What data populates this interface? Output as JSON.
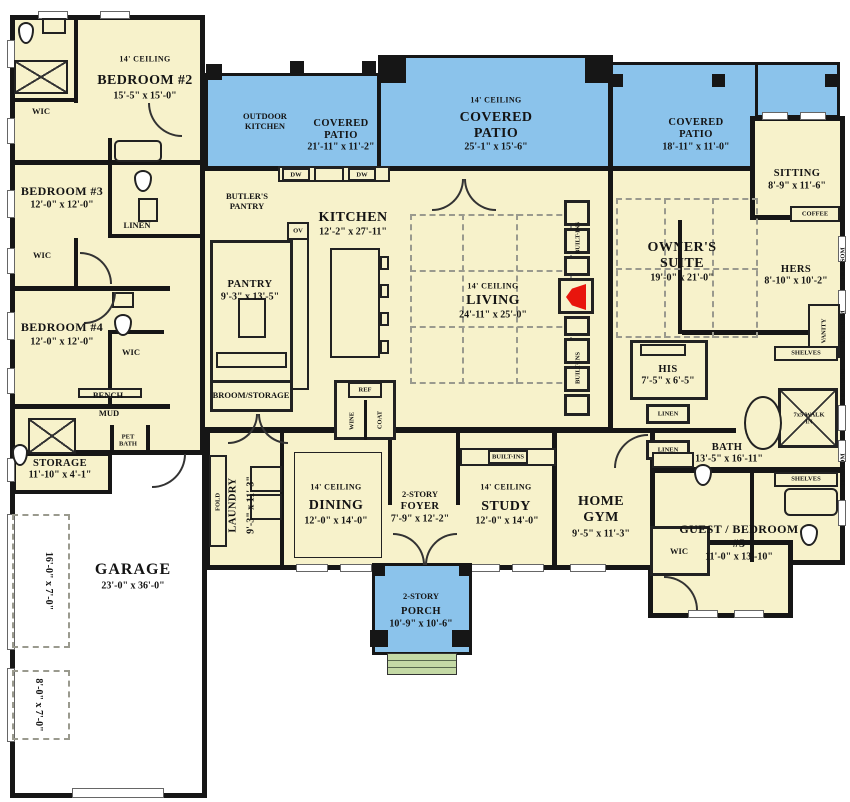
{
  "colors": {
    "floor": "#F7F2CB",
    "patio": "#8BC3EB",
    "steps": "#C4D9A5",
    "wall": "#161616",
    "fire": "#E8150D",
    "dash": "#9a9a8e"
  },
  "rooms": {
    "bedroom2": {
      "ceiling": "14' CEILING",
      "name": "BEDROOM #2",
      "dims": "15'-5\" x 15'-0\""
    },
    "bedroom3": {
      "name": "BEDROOM #3",
      "dims": "12'-0\" x 12'-0\""
    },
    "bedroom4": {
      "name": "BEDROOM #4",
      "dims": "12'-0\" x 12'-0\""
    },
    "patio_left": {
      "name": "COVERED PATIO",
      "dims": "21'-11\" x 11'-2\""
    },
    "patio_center": {
      "ceiling": "14' CEILING",
      "name": "COVERED PATIO",
      "dims": "25'-1\" x 15'-6\""
    },
    "patio_right": {
      "name": "COVERED PATIO",
      "dims": "18'-11\" x 11'-0\""
    },
    "outdoor_kitchen": {
      "name": "OUTDOOR KITCHEN"
    },
    "butlers_pantry": {
      "name": "BUTLER'S PANTRY"
    },
    "kitchen": {
      "name": "KITCHEN",
      "dims": "12'-2\" x 27'-11\""
    },
    "pantry": {
      "name": "PANTRY",
      "dims": "9'-3\" x 13'-5\""
    },
    "broom": {
      "name": "BROOM/STORAGE"
    },
    "living": {
      "ceiling": "14' CEILING",
      "name": "LIVING",
      "dims": "24'-11\" x 25'-0\""
    },
    "owners": {
      "name": "OWNER'S SUITE",
      "dims": "19'-0\" x 21'-0\""
    },
    "sitting": {
      "name": "SITTING",
      "dims": "8'-9\" x 11'-6\""
    },
    "hers": {
      "name": "HERS",
      "dims": "8'-10\" x 10'-2\""
    },
    "his": {
      "name": "HIS",
      "dims": "7'-5\" x 6'-5\""
    },
    "bath": {
      "name": "BATH",
      "dims": "13'-5\" x 16'-11\""
    },
    "walkin": {
      "name": "7x5 WALK IN"
    },
    "storage": {
      "name": "STORAGE",
      "dims": "11'-10\" x 4'-1\""
    },
    "garage": {
      "name": "GARAGE",
      "dims": "23'-0\" x 36'-0\""
    },
    "park1": {
      "dims": "16'-0\" x 7'-0\""
    },
    "park2": {
      "dims": "8'-0\" x 7'-0\""
    },
    "laundry": {
      "name": "LAUNDRY",
      "dims": "9'-3\" x 11'-3\""
    },
    "dining": {
      "ceiling": "14' CEILING",
      "name": "DINING",
      "dims": "12'-0\" x 14'-0\""
    },
    "foyer": {
      "story": "2-STORY",
      "name": "FOYER",
      "dims": "7'-9\" x 12'-2\""
    },
    "study": {
      "ceiling": "14' CEILING",
      "name": "STUDY",
      "dims": "12'-0\" x 14'-0\""
    },
    "gym": {
      "name": "HOME GYM",
      "dims": "9'-5\" x 11'-3\""
    },
    "guest": {
      "name": "GUEST / BEDROOM #5",
      "dims": "11'-0\" x 13'-10\""
    },
    "porch": {
      "story": "2-STORY",
      "name": "PORCH",
      "dims": "10'-9\" x 10'-6\""
    }
  },
  "small": {
    "wic": "WIC",
    "linen": "LINEN",
    "bench": "BENCH",
    "mud": "MUD",
    "pet_bath": "PET BATH",
    "fold": "FOLD",
    "ref": "REF",
    "wine": "WINE",
    "coat": "COAT",
    "dw": "DW",
    "ov": "OV",
    "coffee": "COFFEE",
    "vanity": "VANITY",
    "shelves": "SHELVES",
    "built_ins": "BUILT-INS",
    "transom": "TRANSOM"
  }
}
